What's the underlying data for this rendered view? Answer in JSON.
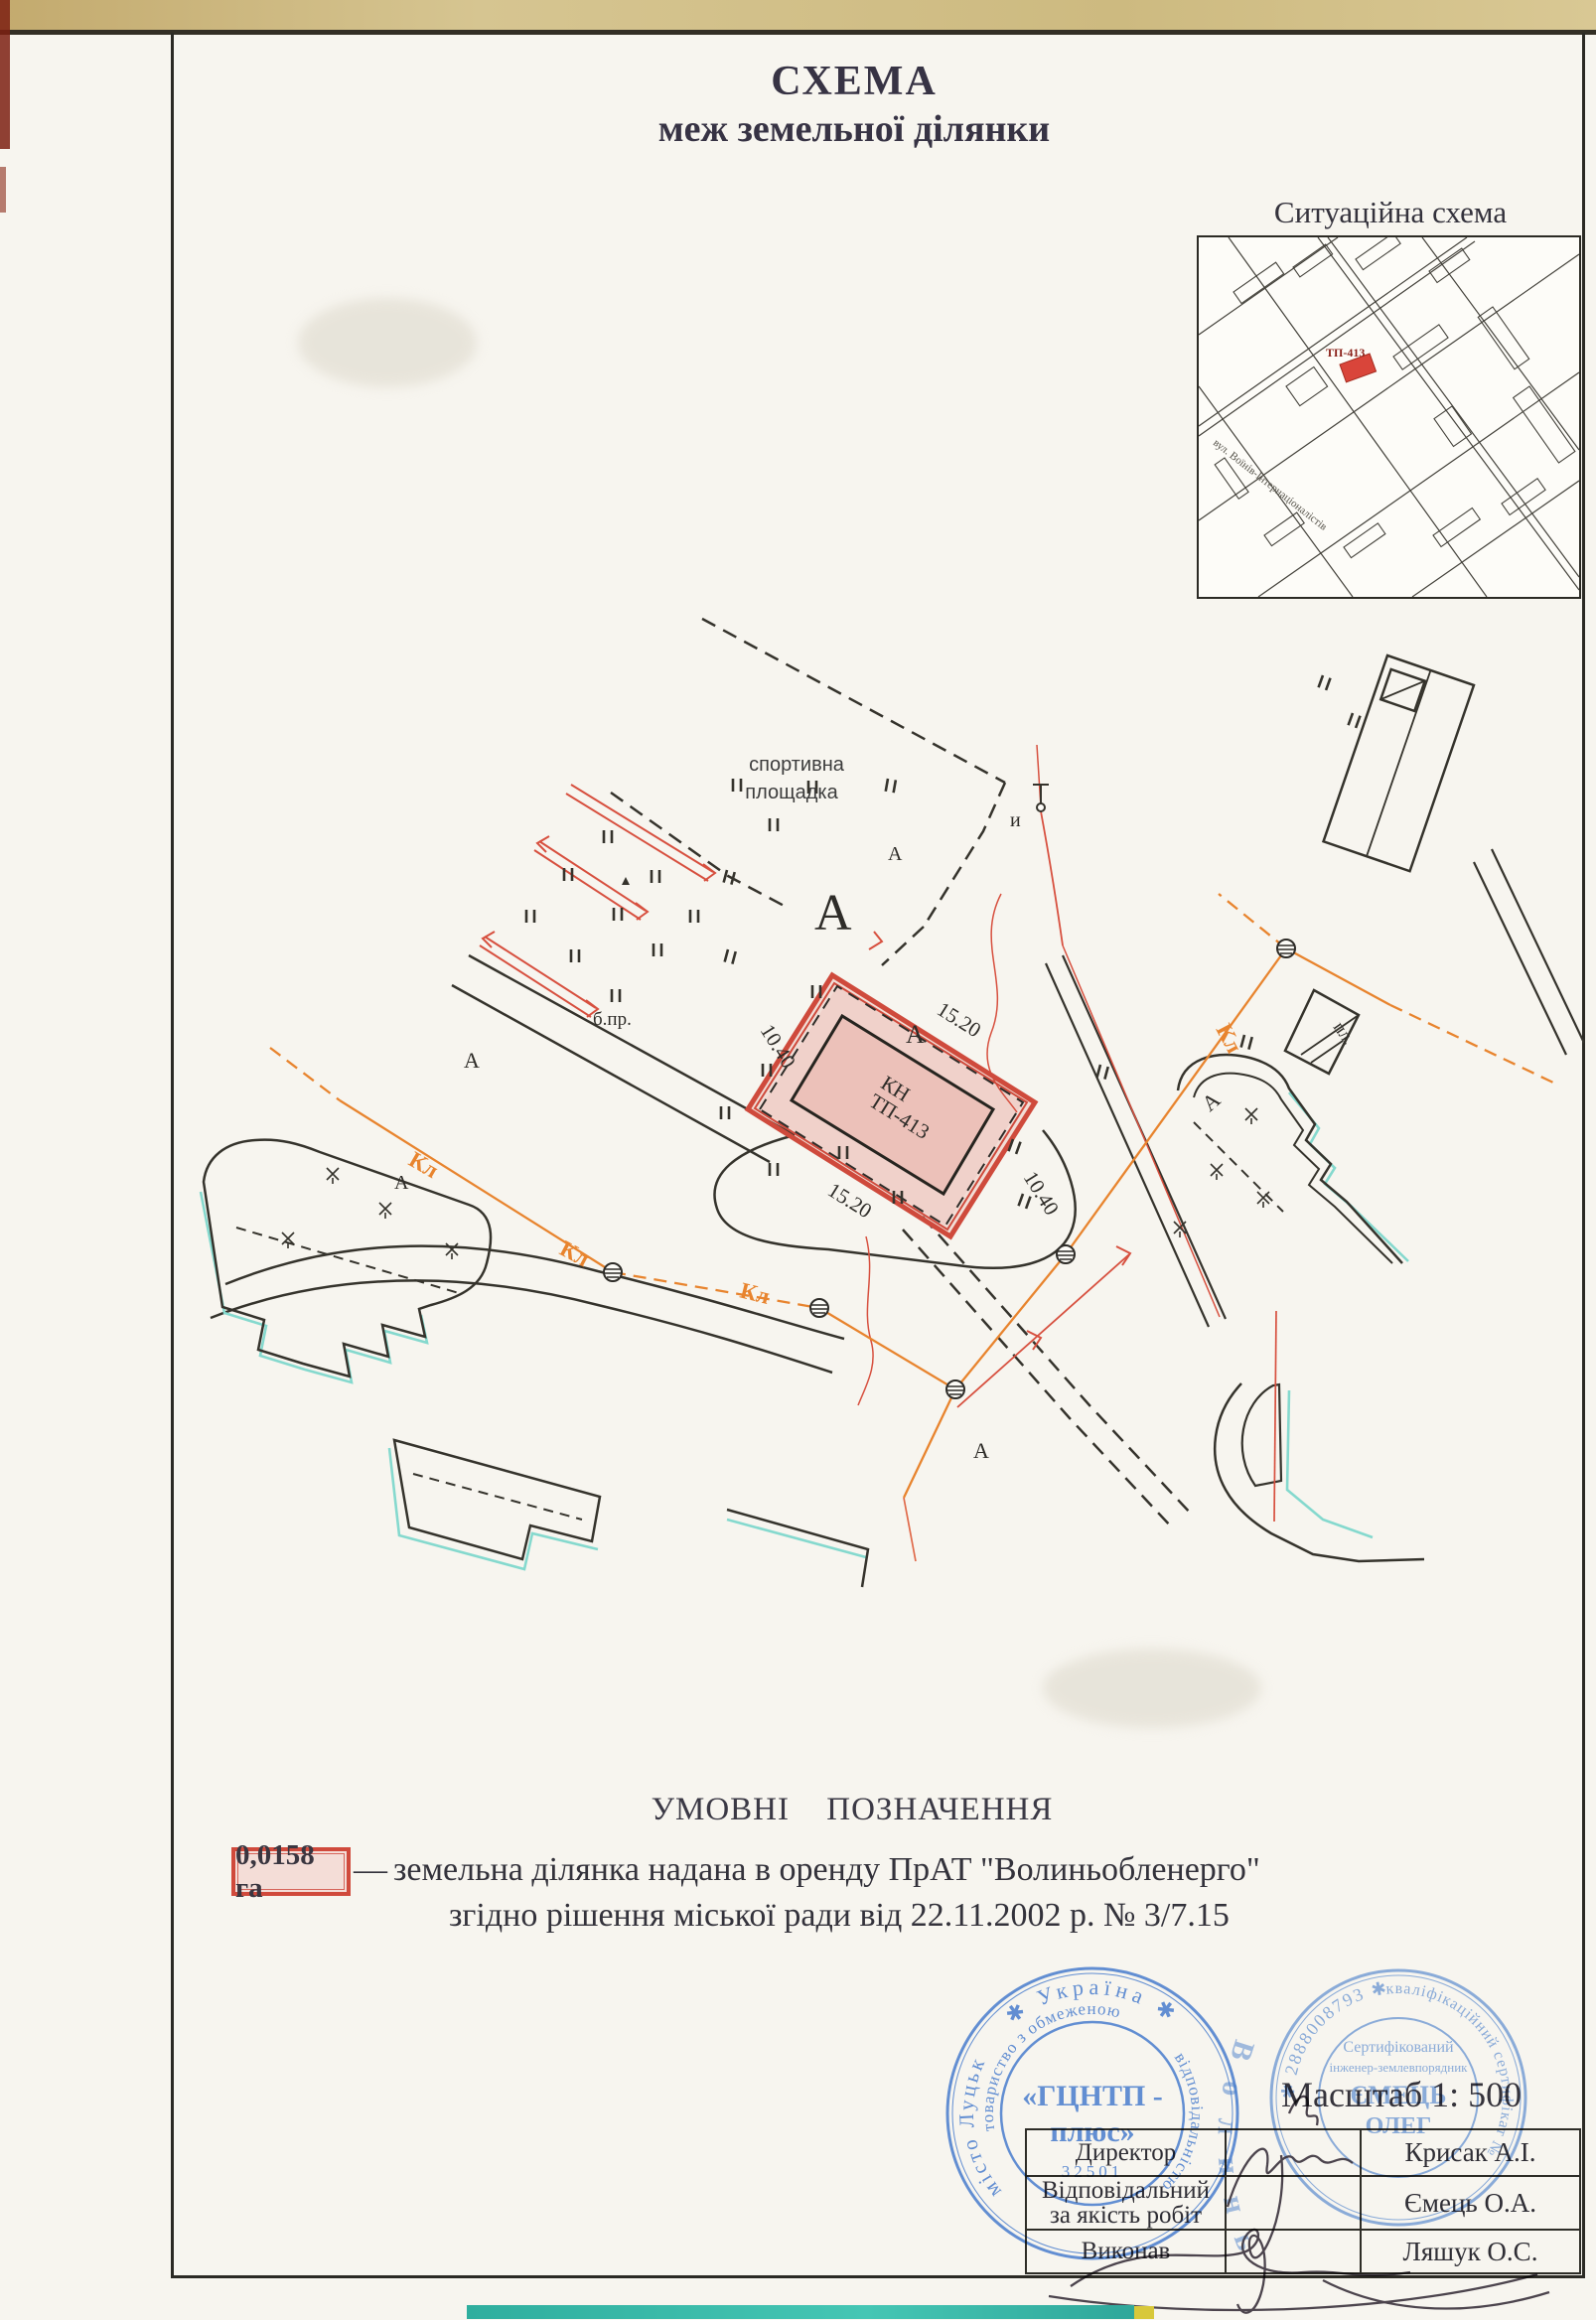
{
  "header": {
    "title": "СХЕМА",
    "subtitle": "меж земельної ділянки"
  },
  "situational": {
    "label": "Ситуаційна схема",
    "marker_label": "ТП-413",
    "street_name": "вул. Воїнів-Інтернаціоналістів"
  },
  "drawing": {
    "sport_label_line1": "спортивна",
    "sport_label_line2": "площадка",
    "plot_code_line1": "КН",
    "plot_code_line2": "ТП-413",
    "dim_long": "15.20",
    "dim_short": "10.40",
    "cable_label": "Кл",
    "area_letter": "А",
    "label_b_pr": "б.пр.",
    "label_pl": "пл.",
    "label_i": "и"
  },
  "legend": {
    "heading": "УМОВНІ ПОЗНАЧЕННЯ",
    "area_value": "0,0158 га",
    "dash": "—",
    "line1": "земельна ділянка надана в оренду  ПрАТ \"Волиньобленерго\"",
    "line2": "згідно рішення міської ради від 22.11.2002 р. № 3/7.15"
  },
  "scale_label": "Масштаб  1: 500",
  "table": {
    "rows": [
      {
        "role": "Директор",
        "name": "Крисак А.І."
      },
      {
        "role": "Відповідальний за якість робіт",
        "name": "Ємець О.А."
      },
      {
        "role": "Виконав",
        "name": "Ляшук О.С."
      }
    ]
  },
  "stamps": {
    "gcntp": {
      "country_ring": "✱  Україна  ✱",
      "city": "місто Луцьк",
      "ring1": "товариство з обмеженою",
      "ring2": "відповідальністю",
      "center_line1": "«ГЦНТП -",
      "center_line2": "плюс»",
      "code": "32501"
    },
    "cert": {
      "number_ring": "✱ 2888008793 ✱",
      "cert_ring": "кваліфікаційний сертифікат №",
      "line1": "Сертифікований",
      "line2": "інженер-землевпорядник",
      "surname": "ЄМЕЦЬ",
      "firstname": "ОЛЕГ"
    },
    "volyn": {
      "arc": "В о л и н ь"
    }
  }
}
